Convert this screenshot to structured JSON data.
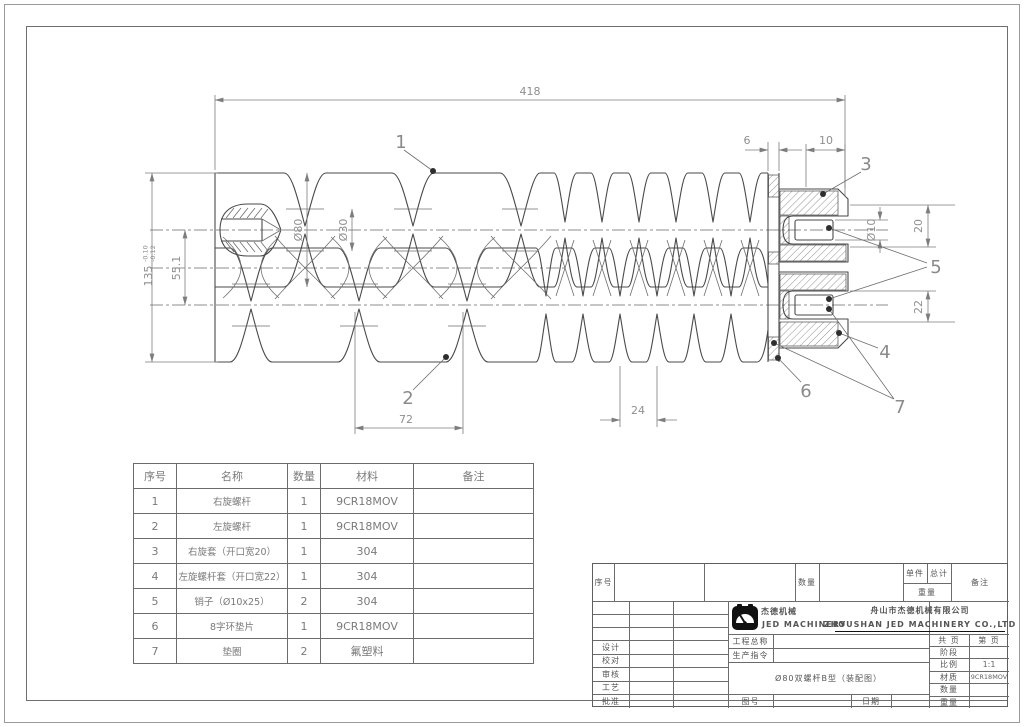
{
  "drawing": {
    "dims": {
      "total_length": "418",
      "overall_height": "135",
      "tol_upper": "-0.10",
      "tol_lower": "-0.12",
      "axis_distance": "55.1",
      "flight_dia": "Ø80",
      "core_dia": "Ø30",
      "coarse_pitch": "72",
      "fine_pitch": "24",
      "gap6": "6",
      "len10": "10",
      "pin_dia": "Ø10",
      "slot20": "20",
      "slot22": "22"
    },
    "balloons": {
      "b1": "1",
      "b2": "2",
      "b3": "3",
      "b4": "4",
      "b5": "5",
      "b6": "6",
      "b7": "7"
    }
  },
  "parts_table": {
    "headers": {
      "no": "序号",
      "name": "名称",
      "qty": "数量",
      "material": "材料",
      "remark": "备注"
    },
    "rows": [
      {
        "no": "1",
        "name": "右旋螺杆",
        "qty": "1",
        "material": "9CR18MOV",
        "remark": ""
      },
      {
        "no": "2",
        "name": "左旋螺杆",
        "qty": "1",
        "material": "9CR18MOV",
        "remark": ""
      },
      {
        "no": "3",
        "name": "右旋套（开口宽20）",
        "qty": "1",
        "material": "304",
        "remark": ""
      },
      {
        "no": "4",
        "name": "左旋螺杆套（开口宽22）",
        "qty": "1",
        "material": "304",
        "remark": ""
      },
      {
        "no": "5",
        "name": "销子（Ø10x25）",
        "qty": "2",
        "material": "304",
        "remark": ""
      },
      {
        "no": "6",
        "name": "8字环垫片",
        "qty": "1",
        "material": "9CR18MOV",
        "remark": ""
      },
      {
        "no": "7",
        "name": "垫圈",
        "qty": "2",
        "material": "氟塑料",
        "remark": ""
      }
    ]
  },
  "title_block": {
    "top": {
      "seq": "序号",
      "qty": "数量",
      "unit": "单件",
      "total": "总计",
      "weight": "重量",
      "remark": "备注"
    },
    "left": {
      "design": "设计",
      "check": "校对",
      "review": "审核",
      "process": "工艺",
      "approve": "批准"
    },
    "brand": {
      "cn": "杰德机械",
      "en": "JED MACHINERY",
      "company_cn": "舟山市杰德机械有限公司",
      "company_en": "ZHOUSHAN JED MACHINERY CO.,LTD"
    },
    "middle": {
      "project_label": "工程总称",
      "order_label": "生产指令",
      "drawing_no_label": "图号",
      "date_label": "日期",
      "title": "Ø80双螺杆B型（装配图）"
    },
    "right": {
      "pages_label": "共  页",
      "page_label": "第  页",
      "stage_label": "阶段",
      "scale_label": "比例",
      "scale_value": "1:1",
      "material_label": "材质",
      "material_value": "9CR18MOV",
      "qty_label": "数量",
      "weight_label": "重量"
    }
  }
}
